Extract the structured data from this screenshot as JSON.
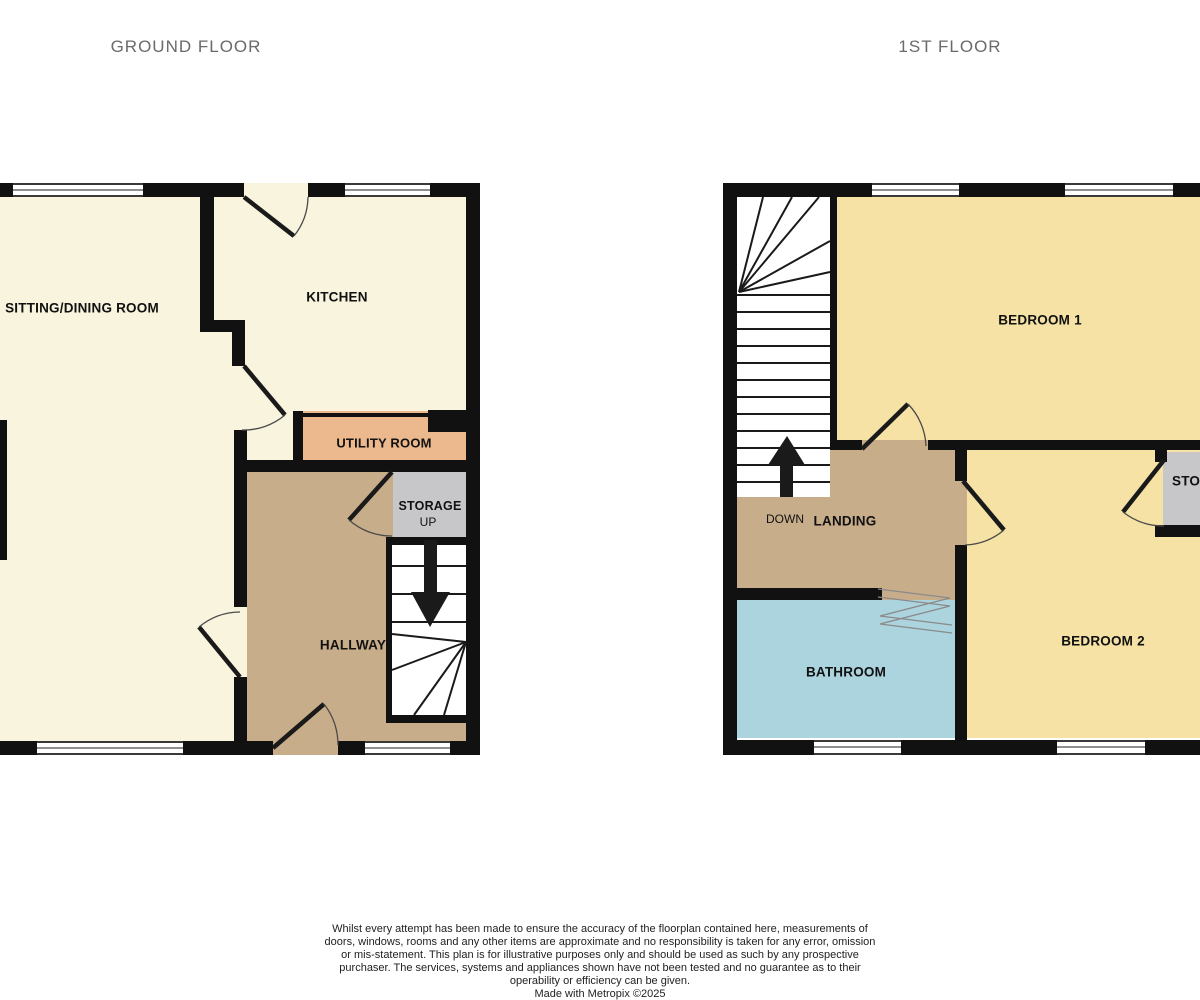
{
  "titles": {
    "ground": "GROUND FLOOR",
    "first": "1ST FLOOR"
  },
  "ground_floor": {
    "rooms": {
      "sitting_dining": "SITTING/DINING ROOM",
      "kitchen": "KITCHEN",
      "utility": "UTILITY ROOM",
      "storage": "STORAGE",
      "hallway": "HALLWAY"
    },
    "stairs_direction": "UP"
  },
  "first_floor": {
    "rooms": {
      "bedroom1": "BEDROOM 1",
      "bedroom2": "BEDROOM 2",
      "bathroom": "BATHROOM",
      "landing": "LANDING",
      "storage": "STORAGE"
    },
    "stairs_direction": "DOWN"
  },
  "footer": {
    "disclaimer": "Whilst every attempt has been made to ensure the accuracy of the floorplan contained here, measurements of doors, windows, rooms and any other items are approximate and no responsibility is taken for any error, omission or mis-statement. This plan is for illustrative purposes only and should be used as such by any prospective purchaser. The services, systems and appliances shown have not been tested and no guarantee as to their operability or efficiency can be given.",
    "credit": "Made with Metropix ©2025"
  },
  "colors": {
    "wall": "#111111",
    "cream": "#F8F4DE",
    "yellow": "#F5E2A4",
    "tan": "#C8AD8B",
    "orange": "#EBB98D",
    "blue": "#ACD4DE",
    "gray": "#C7C7C9",
    "stairs": "#FFFFFF",
    "title_text": "#6A6A6A"
  }
}
